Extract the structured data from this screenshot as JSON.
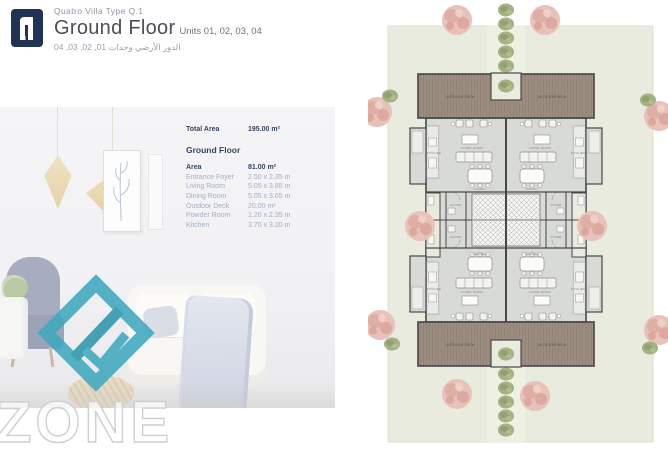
{
  "header": {
    "subtitle": "Quatro Villa Type Q.1",
    "title": "Ground Floor",
    "units": "Units 01, 02, 03, 04",
    "arabic": "الدور الأرضي وحدات 01, 02, 03, 04"
  },
  "specs": {
    "total_area_label": "Total Area",
    "total_area_value": "195.00 m²",
    "section_title": "Ground Floor",
    "area_label": "Area",
    "area_value": "81.00 m²",
    "rooms": [
      {
        "name": "Entrance Foyer",
        "dim": "2.50 x 2.35 m"
      },
      {
        "name": "Living Room",
        "dim": "5.05 x 3.85 m"
      },
      {
        "name": "Dining Room",
        "dim": "5.05 x 3.65 m"
      },
      {
        "name": "Outdoor Deck",
        "dim": "20.00 m²"
      },
      {
        "name": "Powder Room",
        "dim": "1.20 x 2.35 m"
      },
      {
        "name": "Kitchen",
        "dim": "3.70 x 3.20 m"
      }
    ]
  },
  "watermark": {
    "text": "ZONE",
    "diamond_color": "#3fa9bf"
  },
  "plan": {
    "labels": {
      "outdoor_deck": "OUTDOOR DECK",
      "living_room": "LIVING ROOM",
      "dining": "DINING",
      "kitchen": "KITCHEN",
      "foyer": "FOYER"
    },
    "colors": {
      "lawn": "#e9ebdf",
      "deck": "#9c8d81",
      "interior": "#d8dad6",
      "wall": "#47474a",
      "tree_pink": "#e6bcb3",
      "bush_green": "#a2b082",
      "brand_navy": "#1f3455",
      "brand_teal": "#3fa9bf"
    }
  }
}
